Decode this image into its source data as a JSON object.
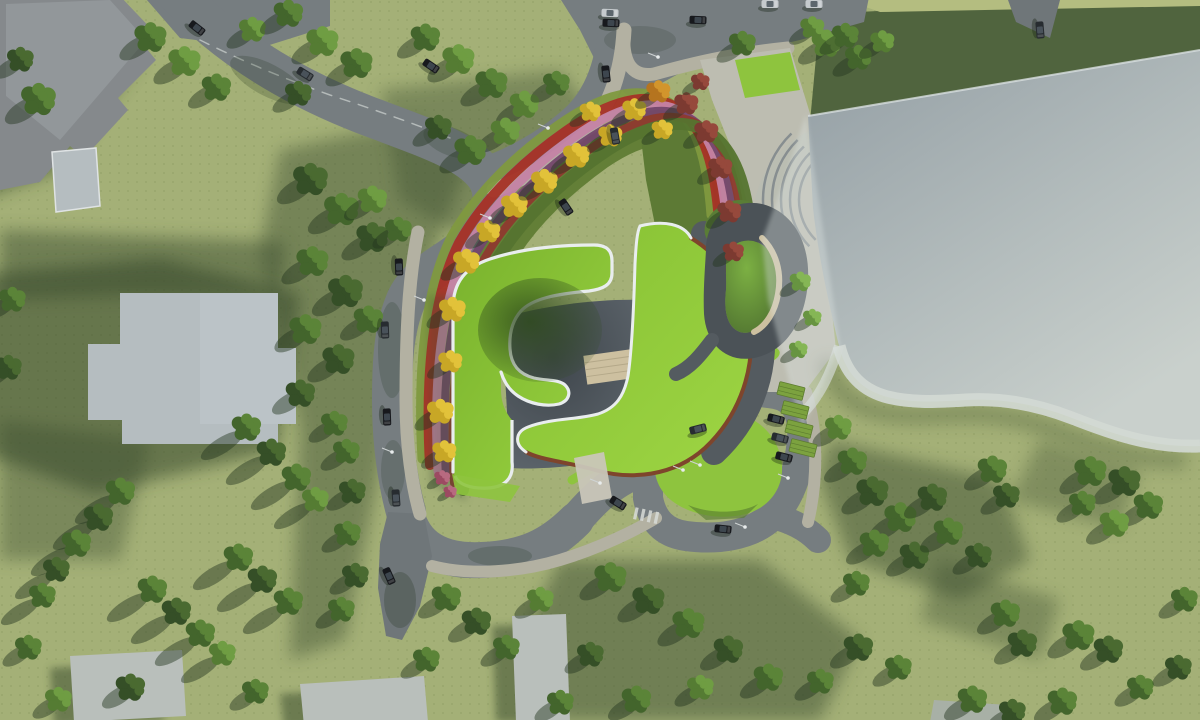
{
  "meta": {
    "title": "Aerial architectural site-plan rendering",
    "description": "Top-down render: lime green-roof building with spiral pavilion, autumn flower beds, curved roads with cars, parking, large glass roof, lawns and trees",
    "canvas": {
      "width": 1200,
      "height": 720
    }
  },
  "palette": {
    "grass": "#a4b077",
    "grass_light": "#b4bd80",
    "grass_shadow": "#3d5030",
    "lawn_dark": "#50643e",
    "lawn_mid": "#6c8a41",
    "lawn_bright": "#8ec43e",
    "road": "#767d80",
    "road_dark": "#6f7679",
    "sidewalk": "#b3b1a2",
    "plaza": "#bdbdb1",
    "roof_green_a": "#79b22d",
    "roof_green_b": "#9bd441",
    "white_edge": "#e9edee",
    "rust": "#7e452c",
    "courtyard_a": "#60686f",
    "courtyard_b": "#3f464c",
    "shell": "#545b60",
    "swirl_dark": "#4b5257",
    "swirl_lawn": "#6fa03c",
    "tan": "#cdc0a0",
    "glass_a": "#939ea4",
    "glass_b": "#c9d0cc",
    "glass_band": "#d3d9d4",
    "bldg_dark": "#85898c",
    "bldg_light": "#b5bdc0",
    "bldg_bottom": "#b9bfbb",
    "tree_shadow": "#243620",
    "f_lime": "#7f993f",
    "f_red": "#a63226",
    "f_pink": "#c583a5",
    "f_purple": "#74476b",
    "f_dred": "#8e3a2e",
    "f_green": "#55742f",
    "lamp": "#e8ecec",
    "car_black": "#17191d",
    "car_gray": "#272c30",
    "car_white": "#c5cacd"
  },
  "tree_variants": {
    "d": {
      "c1": "#354f27",
      "c2": "#4a6a31"
    },
    "m": {
      "c1": "#43652c",
      "c2": "#5b8438"
    },
    "l": {
      "c1": "#557c33",
      "c2": "#6f9d43"
    },
    "b": {
      "c1": "#679441",
      "c2": "#85b655"
    },
    "y": {
      "c1": "#c8a726",
      "c2": "#e2c23a"
    },
    "o": {
      "c1": "#b5741f",
      "c2": "#d2952c"
    },
    "r": {
      "c1": "#7c3a31",
      "c2": "#96493c"
    },
    "p": {
      "c1": "#9c4a62",
      "c2": "#b86a80"
    }
  },
  "trees": [
    [
      38,
      100,
      13,
      "m"
    ],
    [
      20,
      60,
      10,
      "d"
    ],
    [
      150,
      38,
      12,
      "m"
    ],
    [
      184,
      62,
      12,
      "l"
    ],
    [
      216,
      88,
      11,
      "m"
    ],
    [
      252,
      30,
      10,
      "l"
    ],
    [
      288,
      14,
      11,
      "m"
    ],
    [
      322,
      42,
      12,
      "l"
    ],
    [
      356,
      64,
      12,
      "m"
    ],
    [
      298,
      94,
      10,
      "d"
    ],
    [
      425,
      38,
      11,
      "m"
    ],
    [
      458,
      60,
      12,
      "l"
    ],
    [
      491,
      84,
      12,
      "m"
    ],
    [
      524,
      105,
      11,
      "l"
    ],
    [
      556,
      84,
      10,
      "m"
    ],
    [
      505,
      132,
      11,
      "l"
    ],
    [
      470,
      151,
      12,
      "m"
    ],
    [
      438,
      128,
      10,
      "d"
    ],
    [
      310,
      180,
      13,
      "d"
    ],
    [
      341,
      210,
      13,
      "m"
    ],
    [
      372,
      238,
      12,
      "d"
    ],
    [
      312,
      262,
      12,
      "m"
    ],
    [
      345,
      292,
      13,
      "d"
    ],
    [
      305,
      330,
      12,
      "m"
    ],
    [
      338,
      360,
      12,
      "d"
    ],
    [
      372,
      200,
      11,
      "l"
    ],
    [
      398,
      230,
      10,
      "m"
    ],
    [
      368,
      320,
      11,
      "m"
    ],
    [
      300,
      394,
      11,
      "d"
    ],
    [
      334,
      424,
      10,
      "m"
    ],
    [
      12,
      300,
      10,
      "m"
    ],
    [
      8,
      368,
      10,
      "d"
    ],
    [
      346,
      452,
      10,
      "m"
    ],
    [
      352,
      492,
      10,
      "d"
    ],
    [
      347,
      534,
      10,
      "m"
    ],
    [
      355,
      576,
      10,
      "d"
    ],
    [
      341,
      610,
      10,
      "m"
    ],
    [
      120,
      492,
      11,
      "m",
      2
    ],
    [
      98,
      518,
      11,
      "d",
      2
    ],
    [
      76,
      544,
      11,
      "m",
      2
    ],
    [
      56,
      570,
      10,
      "d",
      2
    ],
    [
      42,
      596,
      10,
      "m",
      2
    ],
    [
      152,
      590,
      11,
      "m",
      2
    ],
    [
      176,
      612,
      11,
      "d",
      2
    ],
    [
      200,
      634,
      11,
      "m",
      2
    ],
    [
      222,
      654,
      10,
      "l",
      2
    ],
    [
      238,
      558,
      11,
      "m",
      2
    ],
    [
      262,
      580,
      11,
      "d",
      2
    ],
    [
      288,
      602,
      11,
      "m",
      2
    ],
    [
      246,
      428,
      11,
      "m",
      2
    ],
    [
      271,
      453,
      11,
      "d",
      2
    ],
    [
      296,
      478,
      11,
      "m",
      2
    ],
    [
      315,
      500,
      10,
      "l",
      2
    ],
    [
      28,
      648,
      10,
      "m"
    ],
    [
      130,
      688,
      11,
      "d"
    ],
    [
      255,
      692,
      10,
      "m"
    ],
    [
      58,
      700,
      10,
      "l"
    ],
    [
      446,
      598,
      11,
      "m"
    ],
    [
      476,
      622,
      11,
      "d"
    ],
    [
      506,
      648,
      10,
      "m"
    ],
    [
      540,
      600,
      10,
      "l"
    ],
    [
      426,
      660,
      10,
      "m"
    ],
    [
      610,
      578,
      12,
      "m"
    ],
    [
      648,
      600,
      12,
      "d"
    ],
    [
      688,
      624,
      12,
      "m"
    ],
    [
      728,
      650,
      11,
      "d"
    ],
    [
      768,
      678,
      11,
      "m"
    ],
    [
      700,
      688,
      10,
      "l"
    ],
    [
      636,
      700,
      11,
      "m"
    ],
    [
      590,
      655,
      10,
      "d"
    ],
    [
      820,
      682,
      10,
      "m"
    ],
    [
      858,
      648,
      11,
      "d"
    ],
    [
      898,
      668,
      10,
      "m"
    ],
    [
      560,
      703,
      10,
      "m"
    ],
    [
      838,
      428,
      10,
      "l"
    ],
    [
      852,
      462,
      11,
      "m"
    ],
    [
      872,
      492,
      12,
      "d"
    ],
    [
      900,
      518,
      12,
      "m"
    ],
    [
      932,
      498,
      11,
      "d"
    ],
    [
      874,
      544,
      11,
      "m"
    ],
    [
      914,
      556,
      11,
      "d"
    ],
    [
      948,
      532,
      11,
      "m"
    ],
    [
      978,
      556,
      10,
      "d"
    ],
    [
      856,
      584,
      10,
      "m"
    ],
    [
      992,
      470,
      11,
      "m"
    ],
    [
      1006,
      496,
      10,
      "d"
    ],
    [
      1090,
      472,
      12,
      "m"
    ],
    [
      1124,
      482,
      12,
      "d"
    ],
    [
      1148,
      506,
      11,
      "m"
    ],
    [
      1114,
      524,
      11,
      "l"
    ],
    [
      1082,
      504,
      10,
      "m"
    ],
    [
      1005,
      614,
      11,
      "m"
    ],
    [
      1022,
      644,
      11,
      "d"
    ],
    [
      1078,
      636,
      12,
      "m"
    ],
    [
      1108,
      650,
      11,
      "d"
    ],
    [
      972,
      700,
      11,
      "m"
    ],
    [
      1012,
      712,
      10,
      "d"
    ],
    [
      1062,
      702,
      11,
      "m"
    ],
    [
      1140,
      688,
      10,
      "m"
    ],
    [
      1178,
      668,
      10,
      "d"
    ],
    [
      1184,
      600,
      10,
      "m"
    ],
    [
      742,
      44,
      10,
      "m"
    ],
    [
      826,
      44,
      11,
      "l"
    ],
    [
      858,
      58,
      10,
      "m"
    ],
    [
      812,
      28,
      9,
      "l"
    ],
    [
      845,
      36,
      10,
      "m"
    ],
    [
      882,
      42,
      9,
      "l"
    ],
    [
      800,
      282,
      8,
      "b"
    ],
    [
      812,
      318,
      7,
      "b"
    ],
    [
      798,
      350,
      7,
      "b"
    ],
    [
      444,
      452,
      9,
      "y"
    ],
    [
      440,
      412,
      10,
      "y"
    ],
    [
      450,
      362,
      9,
      "y"
    ],
    [
      452,
      310,
      10,
      "y"
    ],
    [
      466,
      262,
      10,
      "y"
    ],
    [
      488,
      232,
      9,
      "y"
    ],
    [
      514,
      206,
      10,
      "y"
    ],
    [
      544,
      182,
      10,
      "y"
    ],
    [
      576,
      156,
      10,
      "y"
    ],
    [
      610,
      136,
      9,
      "y"
    ],
    [
      590,
      112,
      8,
      "y"
    ],
    [
      634,
      110,
      9,
      "y"
    ],
    [
      658,
      92,
      9,
      "o"
    ],
    [
      662,
      130,
      8,
      "y"
    ],
    [
      686,
      104,
      9,
      "r"
    ],
    [
      706,
      132,
      9,
      "r"
    ],
    [
      720,
      168,
      9,
      "r"
    ],
    [
      729,
      212,
      9,
      "r"
    ],
    [
      733,
      252,
      8,
      "r"
    ],
    [
      700,
      82,
      7,
      "r"
    ],
    [
      442,
      478,
      6,
      "p"
    ],
    [
      450,
      492,
      5,
      "p"
    ]
  ],
  "cars": [
    [
      610,
      13,
      2,
      "w"
    ],
    [
      611,
      23,
      2,
      "k"
    ],
    [
      698,
      20,
      2,
      "k"
    ],
    [
      770,
      4,
      0,
      "w"
    ],
    [
      814,
      4,
      0,
      "w"
    ],
    [
      606,
      74,
      84,
      "k"
    ],
    [
      615,
      136,
      80,
      "g"
    ],
    [
      197,
      28,
      38,
      "k"
    ],
    [
      305,
      74,
      32,
      "g"
    ],
    [
      431,
      66,
      34,
      "k"
    ],
    [
      566,
      207,
      56,
      "k"
    ],
    [
      399,
      267,
      88,
      "k"
    ],
    [
      385,
      330,
      88,
      "g"
    ],
    [
      387,
      417,
      88,
      "k"
    ],
    [
      396,
      498,
      86,
      "g"
    ],
    [
      389,
      576,
      66,
      "k"
    ],
    [
      618,
      503,
      32,
      "k"
    ],
    [
      698,
      429,
      -14,
      "g"
    ],
    [
      723,
      529,
      6,
      "k"
    ],
    [
      776,
      419,
      14,
      "k"
    ],
    [
      780,
      438,
      14,
      "g"
    ],
    [
      784,
      457,
      14,
      "k"
    ],
    [
      1040,
      30,
      85,
      "g"
    ]
  ],
  "lamps": [
    [
      392,
      452
    ],
    [
      424,
      300
    ],
    [
      490,
      218
    ],
    [
      548,
      128
    ],
    [
      600,
      483
    ],
    [
      683,
      470
    ],
    [
      788,
      478
    ],
    [
      745,
      527
    ],
    [
      658,
      57
    ],
    [
      700,
      465
    ]
  ],
  "parking_pads": [
    [
      795,
      410
    ],
    [
      799,
      429
    ],
    [
      803,
      448
    ],
    [
      791,
      391
    ]
  ],
  "flower_stripes": [
    {
      "dx": -15,
      "dy": -11,
      "w": 9,
      "color": "f_lime"
    },
    {
      "dx": -7,
      "dy": -5,
      "w": 10,
      "color": "f_red"
    },
    {
      "dx": 1,
      "dy": 1,
      "w": 9,
      "color": "f_pink"
    },
    {
      "dx": 9,
      "dy": 7,
      "w": 8,
      "color": "f_purple"
    },
    {
      "dx": 17,
      "dy": 13,
      "w": 8,
      "color": "f_dred"
    },
    {
      "dx": 26,
      "dy": 20,
      "w": 12,
      "color": "f_green"
    }
  ],
  "amphitheater": {
    "cx": 855,
    "cy": 200,
    "radii": [
      56,
      65,
      74,
      83,
      92
    ],
    "a1": 2.35,
    "a2": 3.95
  }
}
